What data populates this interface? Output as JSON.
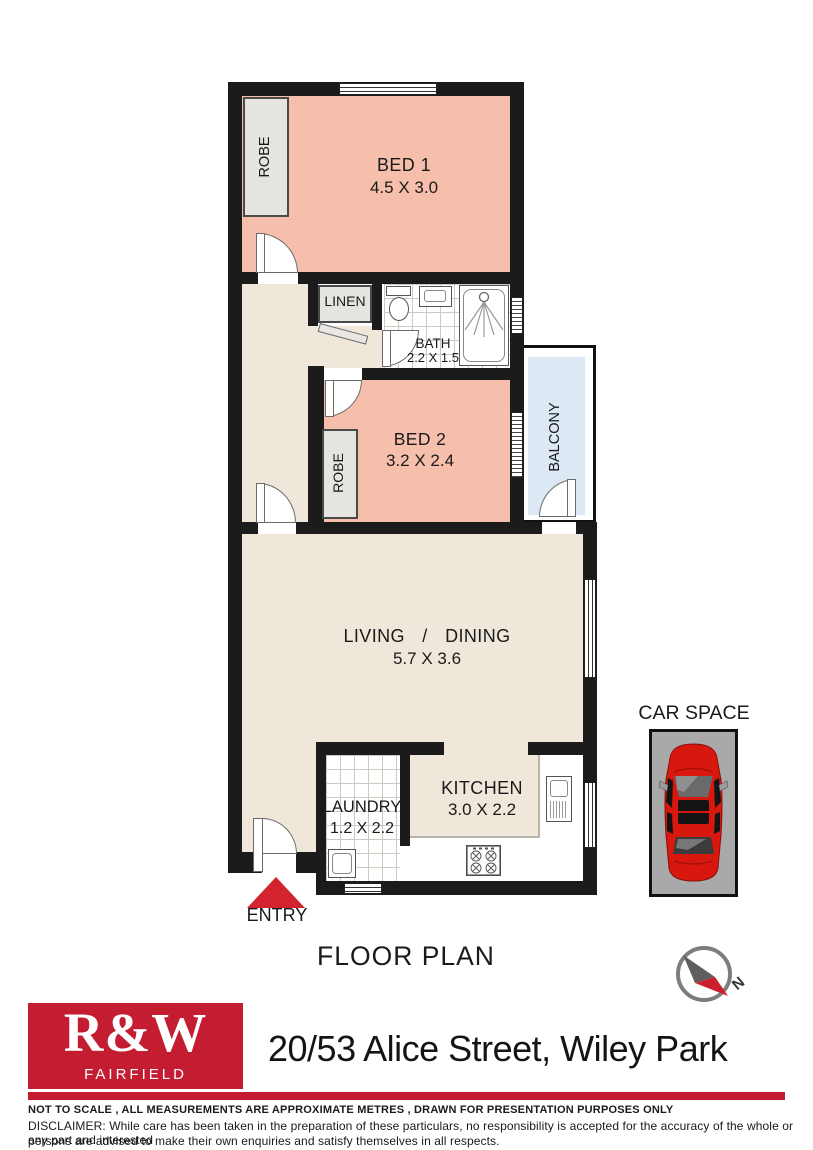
{
  "title": "FLOOR PLAN",
  "entry_label": "ENTRY",
  "car_space": {
    "label": "CAR SPACE"
  },
  "compass": {
    "north": "N"
  },
  "rooms": {
    "bed1": {
      "name": "BED 1",
      "dims": "4.5 X 3.0"
    },
    "bed2": {
      "name": "BED 2",
      "dims": "3.2 X 2.4"
    },
    "bath": {
      "name": "BATH",
      "dims": "2.2 X 1.5"
    },
    "living": {
      "name": "LIVING / DINING",
      "dims": "5.7 X 3.6"
    },
    "kitchen": {
      "name": "KITCHEN",
      "dims": "3.0 X 2.2"
    },
    "laundry": {
      "name": "LAUNDRY",
      "dims": "1.2 X 2.2"
    },
    "linen": {
      "name": "LINEN"
    },
    "robe1": {
      "name": "ROBE"
    },
    "robe2": {
      "name": "ROBE"
    },
    "balcony": {
      "name": "BALCONY"
    }
  },
  "footer": {
    "brand": "R&W",
    "office": "FAIRFIELD",
    "address": "20/53 Alice Street, Wiley Park",
    "note": "NOT TO SCALE , ALL MEASUREMENTS ARE APPROXIMATE METRES , DRAWN FOR PRESENTATION PURPOSES ONLY",
    "disclaimer_line1": "DISCLAIMER:  While care has been taken in the preparation of these particulars, no responsibility is accepted for the accuracy of the whole or any part and interested",
    "disclaimer_line2": "persons are advised to make their own enquiries and satisfy  themselves in all respects."
  },
  "colors": {
    "wall": "#1b1b1b",
    "bedroom_fill": "#f6bfac",
    "floor_fill": "#efe8da",
    "balcony_fill": "#dce8f4",
    "closet_fill": "#e6e4e1",
    "brand_red": "#c41d32",
    "entry_red": "#d2232e",
    "car_red": "#d8170e",
    "car_pad_gray": "#a9a9a9"
  }
}
